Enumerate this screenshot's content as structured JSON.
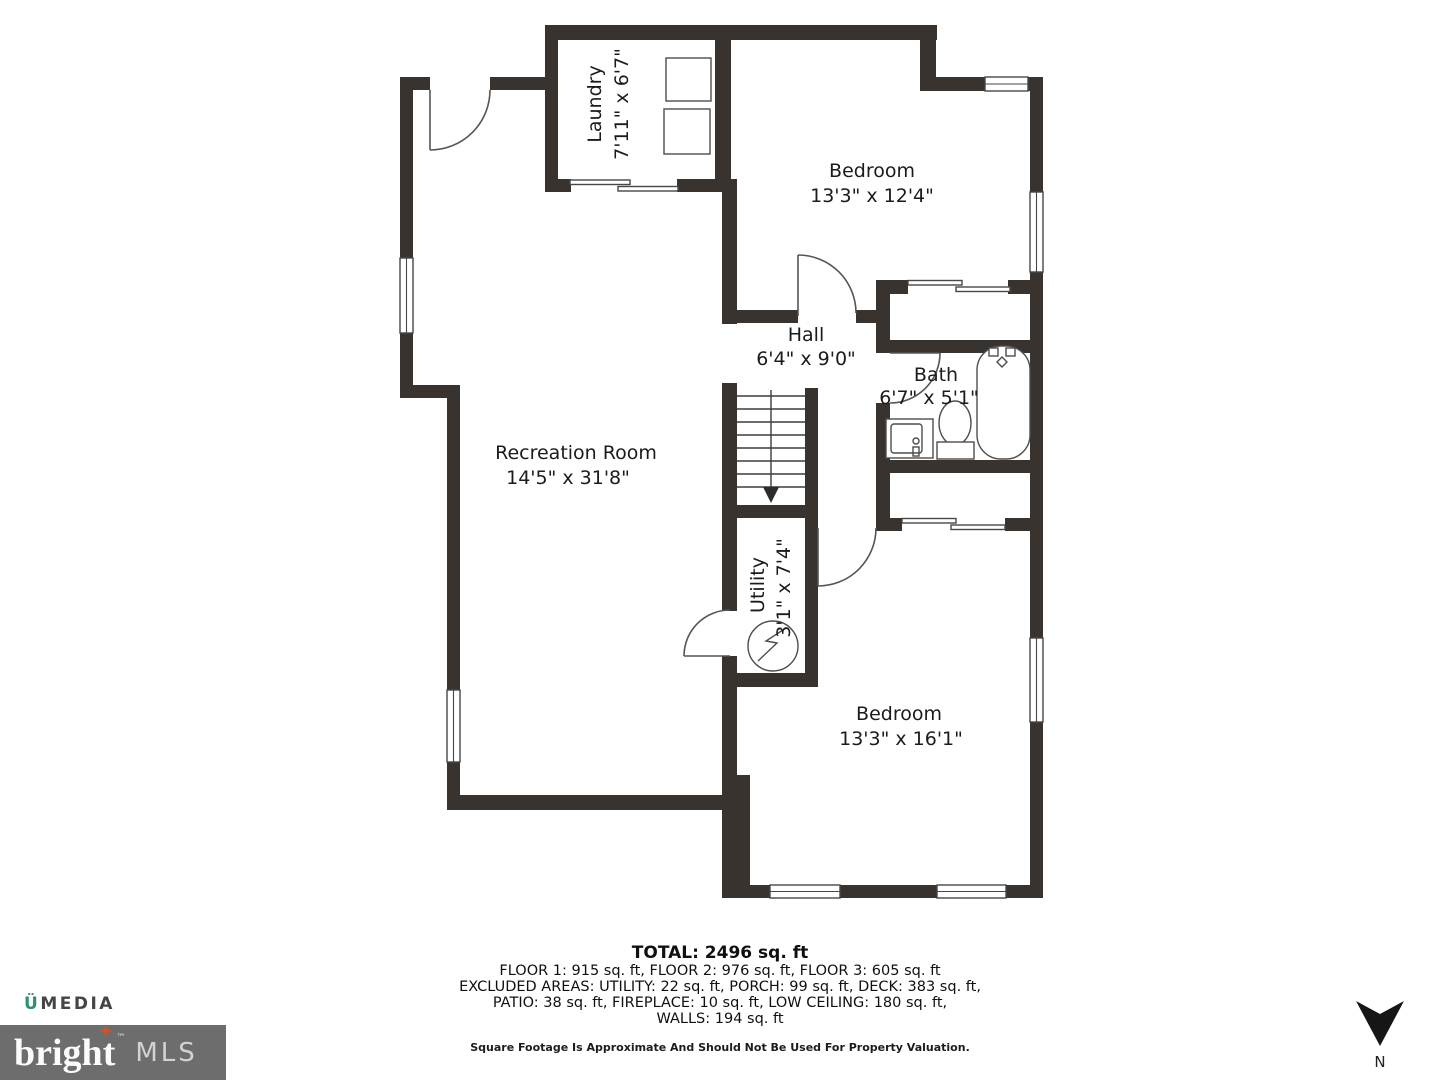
{
  "plan": {
    "rooms": [
      {
        "name": "Laundry",
        "dims": "7'11\" x 6'7\""
      },
      {
        "name": "Bedroom",
        "dims": "13'3\" x 12'4\""
      },
      {
        "name": "Hall",
        "dims": "6'4\" x 9'0\""
      },
      {
        "name": "Bath",
        "dims": "6'7\" x 5'1\""
      },
      {
        "name": "Recreation Room",
        "dims": "14'5\" x 31'8\""
      },
      {
        "name": "Utility",
        "dims": "3'1\" x 7'4\""
      },
      {
        "name": "Bedroom",
        "dims": "13'3\" x 16'1\""
      }
    ]
  },
  "summary": {
    "total": "TOTAL: 2496 sq. ft",
    "line1": "FLOOR 1: 915 sq. ft, FLOOR 2: 976 sq. ft, FLOOR 3: 605 sq. ft",
    "line2": "EXCLUDED AREAS: UTILITY: 22 sq. ft, PORCH: 99 sq. ft, DECK: 383 sq. ft,",
    "line3": "PATIO: 38 sq. ft, FIREPLACE: 10 sq. ft, LOW CEILING: 180 sq. ft,",
    "line4": "WALLS: 194 sq. ft",
    "disclaimer": "Square Footage Is Approximate And Should Not Be Used For Property Valuation."
  },
  "branding": {
    "umedia_u": "Ü",
    "umedia_rest": "MEDIA",
    "bright_text_start": "brigh",
    "bright_text_t": "t",
    "bright_star": "✦",
    "bright_tm": "™",
    "mls_text": "MLS",
    "accent_green": "#2f8f70",
    "star_orange": "#d6502a",
    "box_gray": "#6d6d6d"
  },
  "compass": {
    "label": "N"
  }
}
